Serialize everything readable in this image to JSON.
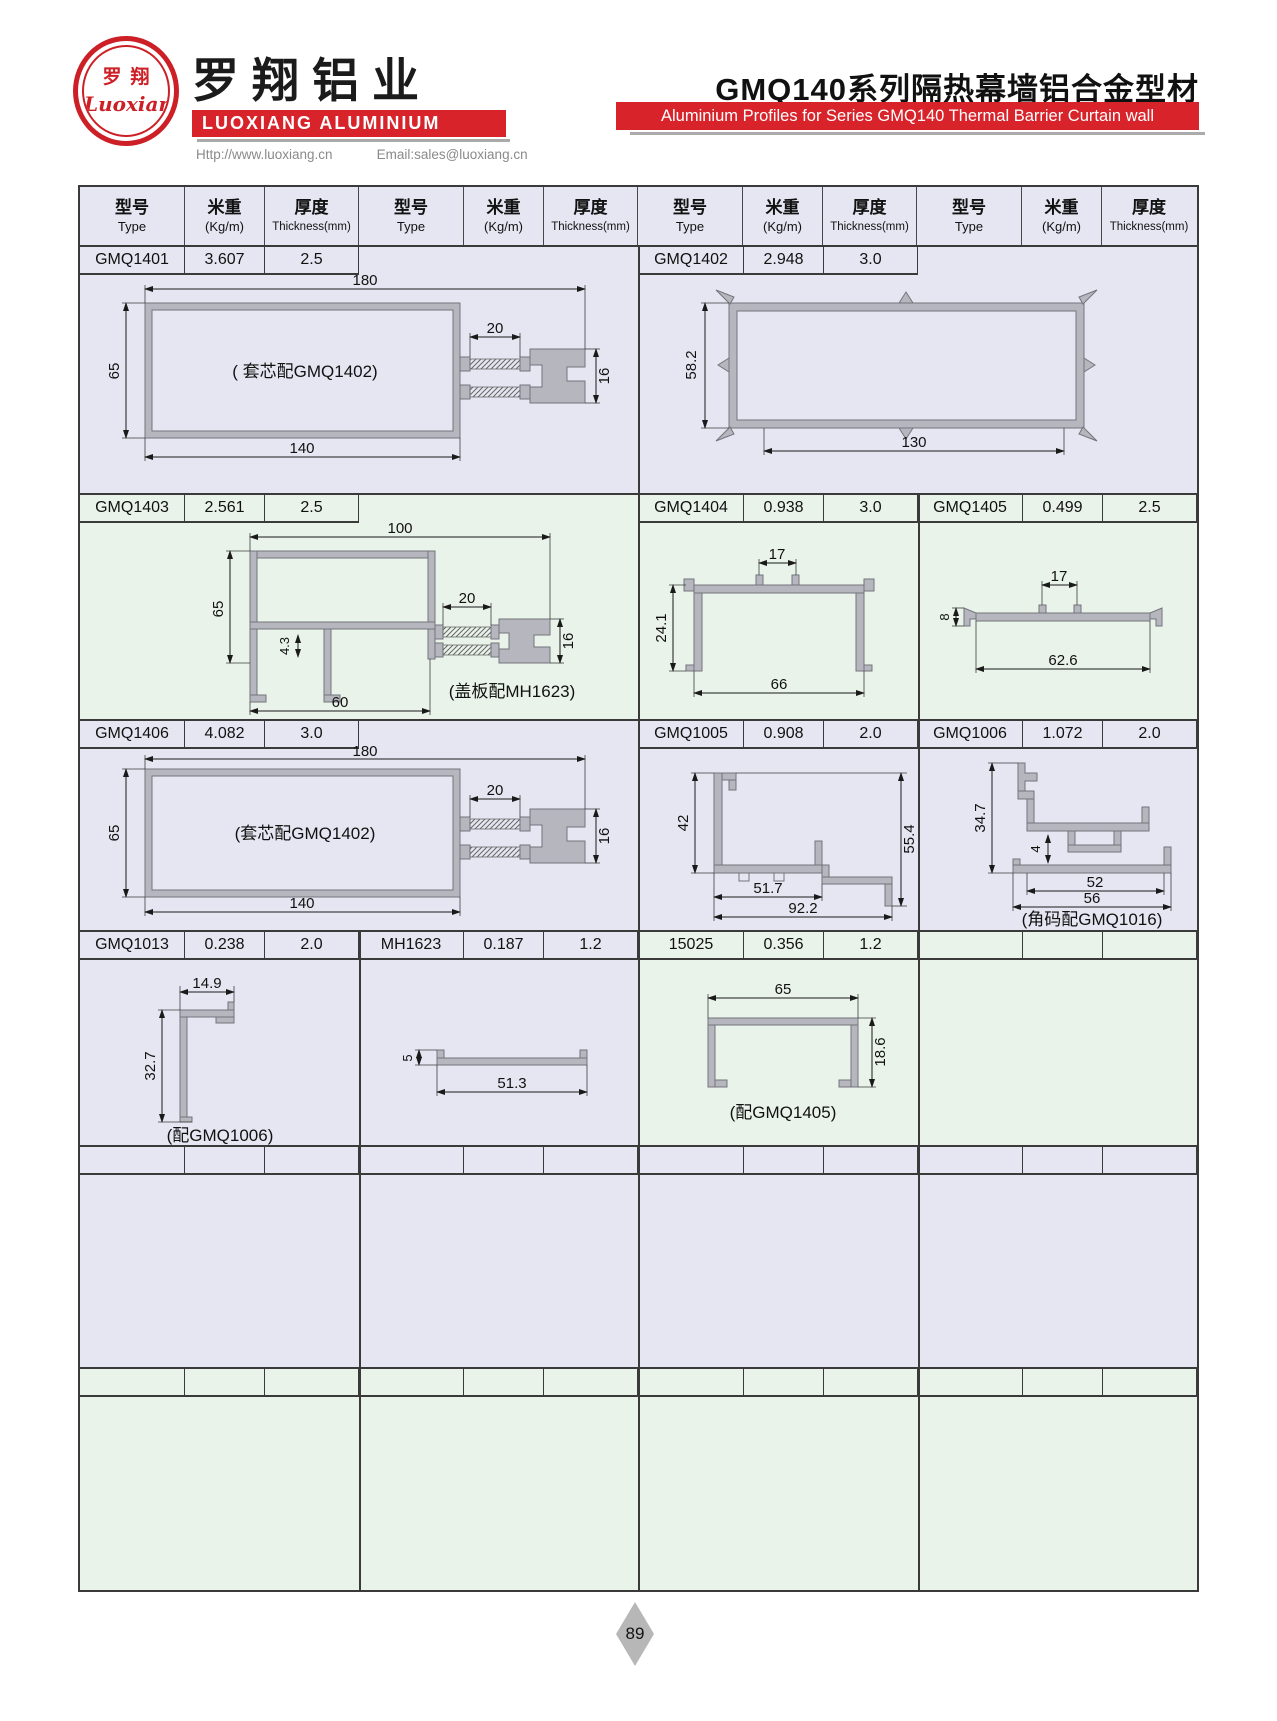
{
  "brand": {
    "logo_cn": "罗翔",
    "logo_script": "Luoxiang",
    "company_cn": "罗翔铝业",
    "company_en": "LUOXIANG ALUMINIUM",
    "website": "Http://www.luoxiang.cn",
    "email": "Email:sales@luoxiang.cn"
  },
  "series": {
    "title_cn": "GMQ140系列隔热幕墙铝合金型材",
    "title_en": "Aluminium Profiles for Series GMQ140 Thermal Barrier Curtain wall"
  },
  "columns": {
    "type_cn": "型号",
    "type_en": "Type",
    "weight_cn": "米重",
    "weight_en": "(Kg/m)",
    "thickness_cn": "厚度",
    "thickness_en": "Thickness(mm)"
  },
  "profiles": {
    "p1401": {
      "type": "GMQ1401",
      "weight": "3.607",
      "thickness": "2.5",
      "caption": "( 套芯配GMQ1402)",
      "d_top": "180",
      "d_left": "65",
      "d_bottom": "140",
      "d_gap": "20",
      "d_right": "16"
    },
    "p1402": {
      "type": "GMQ1402",
      "weight": "2.948",
      "thickness": "3.0",
      "d_left": "58.2",
      "d_bottom": "130"
    },
    "p1403": {
      "type": "GMQ1403",
      "weight": "2.561",
      "thickness": "2.5",
      "caption": "(盖板配MH1623)",
      "d_top": "100",
      "d_left": "65",
      "d_inner": "4.3",
      "d_bottom": "60",
      "d_gap": "20",
      "d_right": "16"
    },
    "p1404": {
      "type": "GMQ1404",
      "weight": "0.938",
      "thickness": "3.0",
      "d_top": "17",
      "d_left": "24.1",
      "d_bottom": "66"
    },
    "p1405": {
      "type": "GMQ1405",
      "weight": "0.499",
      "thickness": "2.5",
      "d_top": "17",
      "d_left": "8",
      "d_bottom": "62.6"
    },
    "p1406": {
      "type": "GMQ1406",
      "weight": "4.082",
      "thickness": "3.0",
      "caption": "(套芯配GMQ1402)",
      "d_top": "180",
      "d_left": "65",
      "d_bottom": "140",
      "d_gap": "20",
      "d_right": "16"
    },
    "p1005": {
      "type": "GMQ1005",
      "weight": "0.908",
      "thickness": "2.0",
      "d_left": "42",
      "d_right": "55.4",
      "d_bottom1": "51.7",
      "d_bottom2": "92.2"
    },
    "p1006": {
      "type": "GMQ1006",
      "weight": "1.072",
      "thickness": "2.0",
      "caption": "(角码配GMQ1016)",
      "d_left": "34.7",
      "d_inner": "4",
      "d_bottom1": "52",
      "d_bottom2": "56"
    },
    "p1013": {
      "type": "GMQ1013",
      "weight": "0.238",
      "thickness": "2.0",
      "caption": "(配GMQ1006)",
      "d_top": "14.9",
      "d_left": "32.7"
    },
    "mh1623": {
      "type": "MH1623",
      "weight": "0.187",
      "thickness": "1.2",
      "d_left": "5",
      "d_bottom": "51.3"
    },
    "p15025": {
      "type": "15025",
      "weight": "0.356",
      "thickness": "1.2",
      "caption": "(配GMQ1405)",
      "d_top": "65",
      "d_right": "18.6"
    }
  },
  "colors": {
    "brand_red": "#d8232a",
    "row_lavender": "#e6e6f2",
    "row_green": "#e9f3e9",
    "profile_fill": "#b6b6be",
    "profile_stroke": "#74747c"
  },
  "page": {
    "number": "89"
  }
}
